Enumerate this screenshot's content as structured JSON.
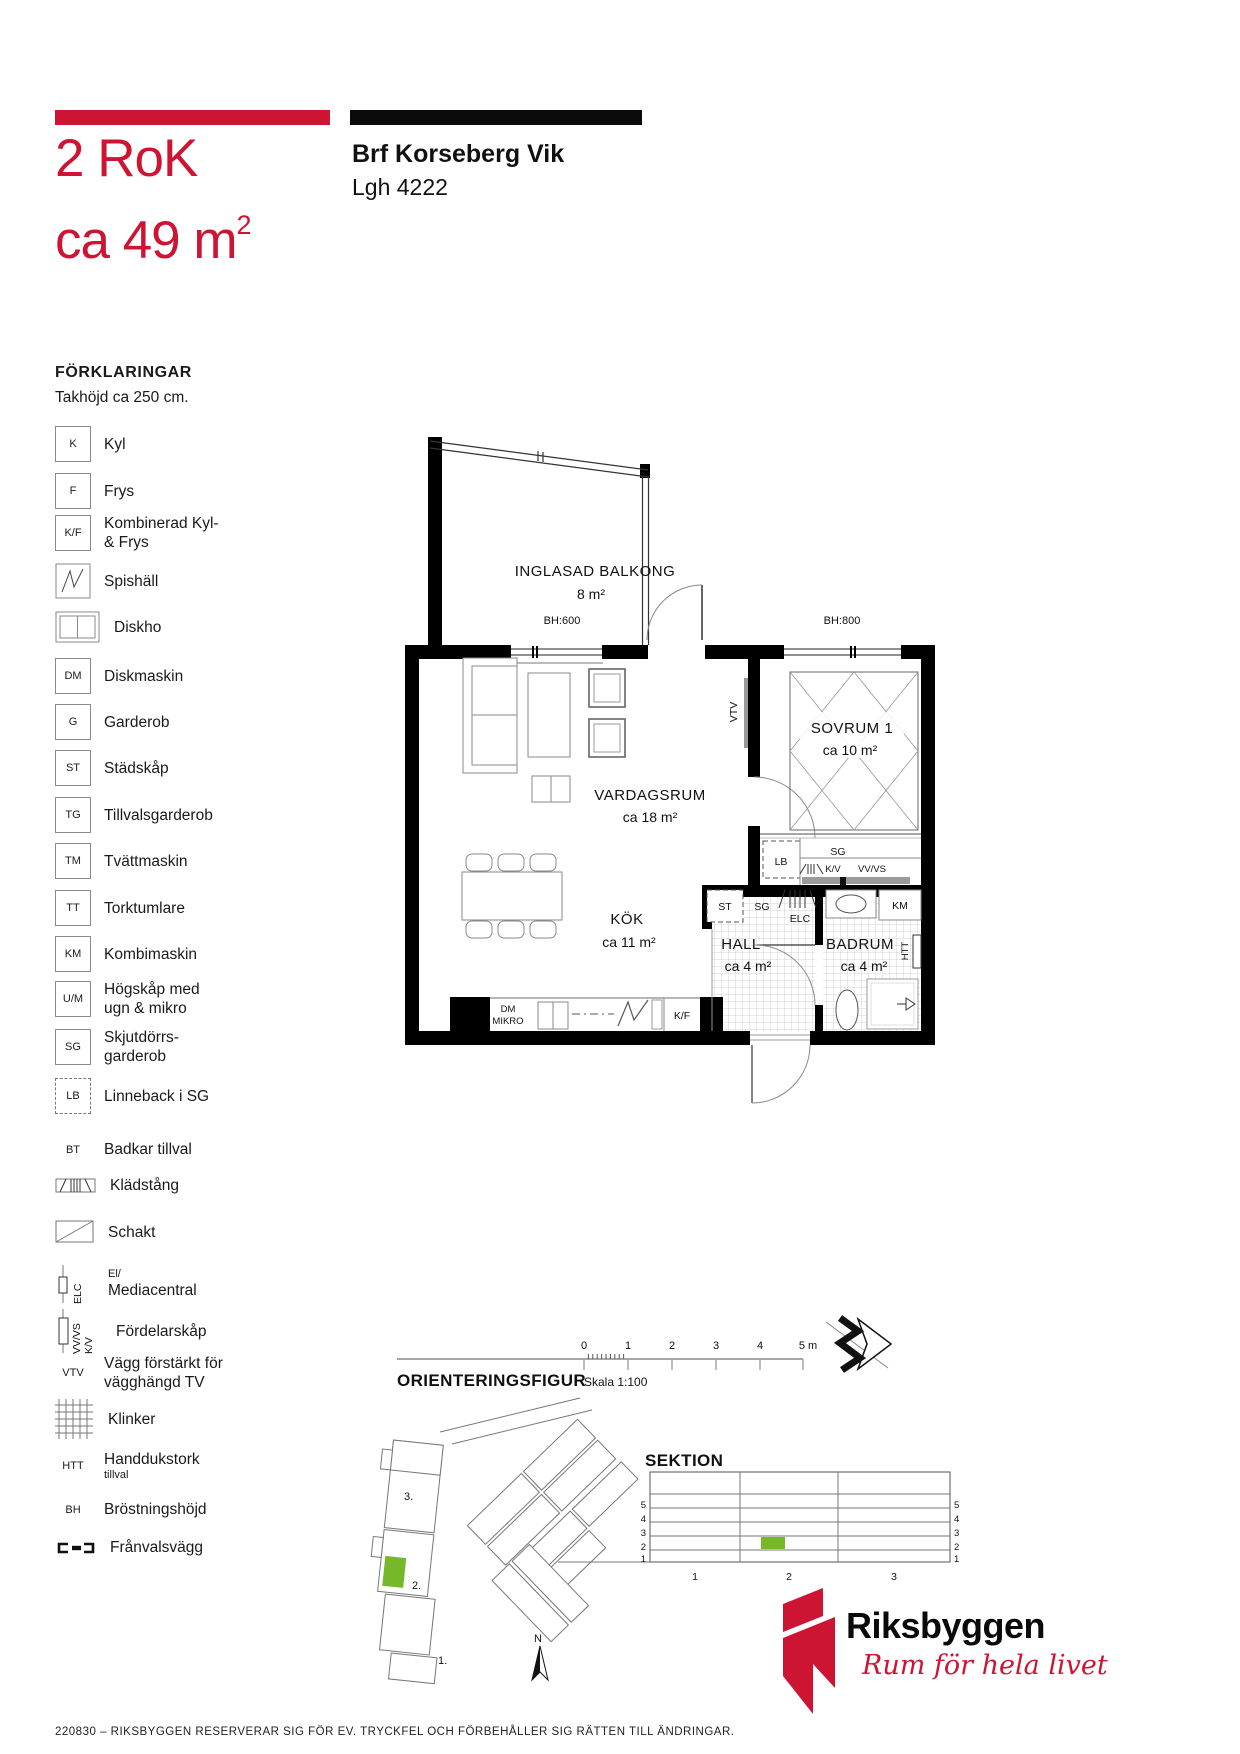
{
  "colors": {
    "brand_red": "#cd1432",
    "highlight_green": "#76b82a"
  },
  "header": {
    "rooms": "2 RoK",
    "area_prefix": "ca 49 m",
    "area_sup": "2",
    "project": "Brf Korseberg Vik",
    "apartment": "Lgh 4222"
  },
  "legend": {
    "heading": "FÖRKLARINGAR",
    "ceiling": "Takhöjd ca 250 cm.",
    "items": [
      {
        "symbol": "K",
        "label": "Kyl"
      },
      {
        "symbol": "F",
        "label": "Frys"
      },
      {
        "symbol": "K/F",
        "label": "Kombinerad Kyl-\n& Frys"
      },
      {
        "symbol": "",
        "label": "Spishäll"
      },
      {
        "symbol": "",
        "label": "Diskho"
      },
      {
        "symbol": "DM",
        "label": "Diskmaskin"
      },
      {
        "symbol": "G",
        "label": "Garderob"
      },
      {
        "symbol": "ST",
        "label": "Städskåp"
      },
      {
        "symbol": "TG",
        "label": "Tillvalsgarderob"
      },
      {
        "symbol": "TM",
        "label": "Tvättmaskin"
      },
      {
        "symbol": "TT",
        "label": "Torktumlare"
      },
      {
        "symbol": "KM",
        "label": "Kombimaskin"
      },
      {
        "symbol": "U/M",
        "label": "Högskåp med\nugn & mikro"
      },
      {
        "symbol": "SG",
        "label": "Skjutdörrs-\ngarderob"
      },
      {
        "symbol": "LB",
        "label": "Linneback i SG"
      },
      {
        "symbol": "BT",
        "label": "Badkar tillval"
      },
      {
        "symbol": "",
        "label": "Klädstång"
      },
      {
        "symbol": "",
        "label": "Schakt"
      },
      {
        "symbol": "ELC",
        "label_small": "El/",
        "label": "Mediacentral"
      },
      {
        "symbol_line1": "VV/VS",
        "symbol_line2": "K/V",
        "label": "Fördelarskåp"
      },
      {
        "symbol": "VTV",
        "label": "Vägg förstärkt för\nvägghängd TV"
      },
      {
        "symbol": "",
        "label": "Klinker"
      },
      {
        "symbol": "HTT",
        "label": "Handdukstork",
        "label_small": "tillval"
      },
      {
        "symbol": "BH",
        "label": "Bröstningshöjd"
      },
      {
        "symbol": "",
        "label": "Frånvalsvägg"
      }
    ]
  },
  "plan": {
    "balcony_name": "INGLASAD BALKONG",
    "balcony_area": "8 m²",
    "bh_600": "BH:600",
    "bh_800": "BH:800",
    "livingroom_name": "VARDAGSRUM",
    "livingroom_area": "ca 18 m²",
    "kitchen_name": "KÖK",
    "kitchen_area": "ca 11 m²",
    "bedroom_name": "SOVRUM 1",
    "bedroom_area": "ca 10 m²",
    "hall_name": "HALL",
    "hall_area": "ca 4 m²",
    "bathroom_name": "BADRUM",
    "bathroom_area": "ca 4 m²",
    "labels": {
      "vtv": "VTV",
      "lb": "LB",
      "sg": "SG",
      "kv": "K/V",
      "vvvs": "VV/VS",
      "st": "ST",
      "sg2": "SG",
      "elc": "ELC",
      "km": "KM",
      "htt": "HTT",
      "dm": "DM",
      "mikro": "MIKRO",
      "kf": "K/F"
    }
  },
  "scalebar": {
    "t0": "0",
    "t1": "1",
    "t2": "2",
    "t3": "3",
    "t4": "4",
    "t5": "5 m",
    "label": "Skala 1:100"
  },
  "orientation": {
    "heading": "ORIENTERINGSFIGUR",
    "b3": "3.",
    "b2": "2.",
    "b1": "1.",
    "north": "N"
  },
  "section": {
    "heading": "SEKTION",
    "fl5": "5",
    "fl4": "4",
    "fl3": "3",
    "fl2": "2",
    "fl1": "1",
    "bay1": "1",
    "bay2": "2",
    "bay3": "3"
  },
  "brand": {
    "name": "Riksbyggen",
    "tagline": "Rum för hela livet"
  },
  "footer": {
    "disclaimer": "220830 – RIKSBYGGEN RESERVERAR SIG FÖR EV. TRYCKFEL OCH FÖRBEHÅLLER SIG RÄTTEN TILL ÄNDRINGAR."
  }
}
